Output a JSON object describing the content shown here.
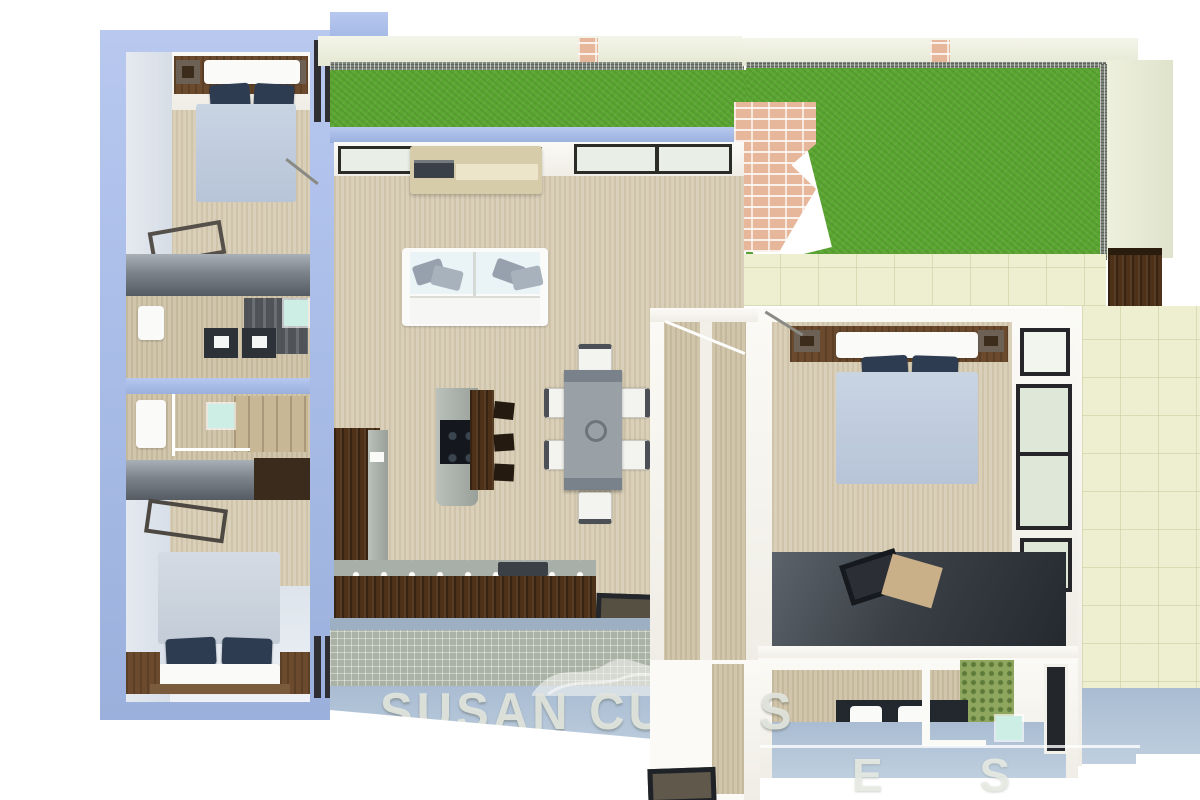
{
  "watermark": {
    "brand": "SUSAN CURTIS",
    "partial_letters": "E S",
    "logo": "mountain-swoosh-icon"
  },
  "scene": {
    "type": "3d-rendered-floor-plan-top-view",
    "rooms": [
      {
        "name": "bedroom-top-left",
        "furniture": [
          "double-bed",
          "navy-pillows",
          "headboard-shelf",
          "luggage-bench"
        ]
      },
      {
        "name": "bathroom-left-upper",
        "furniture": [
          "toilet",
          "washer",
          "dryer",
          "glass-shelf"
        ]
      },
      {
        "name": "bathroom-left-lower",
        "furniture": [
          "vanity-sink",
          "mirror",
          "closet"
        ]
      },
      {
        "name": "bedroom-bottom-left",
        "furniture": [
          "double-bed",
          "navy-pillows",
          "nightstands",
          "luggage-bench"
        ]
      },
      {
        "name": "living-room",
        "furniture": [
          "white-sofa",
          "tv-console",
          "air-conditioner",
          "windows"
        ]
      },
      {
        "name": "kitchen",
        "furniture": [
          "l-shaped-counter",
          "island-cooktop",
          "breakfast-bar",
          "bar-stools",
          "sink",
          "doormat"
        ]
      },
      {
        "name": "dining-area",
        "furniture": [
          "dining-table",
          "six-chairs",
          "center-bowl"
        ]
      },
      {
        "name": "walk-in-closet",
        "furniture": [
          "hanging-rail"
        ]
      },
      {
        "name": "master-bedroom",
        "furniture": [
          "double-bed",
          "navy-pillows",
          "wardrobe-platform",
          "laptop",
          "windows"
        ]
      },
      {
        "name": "master-bathroom",
        "furniture": [
          "double-sink-vanity",
          "shower-partition",
          "mosaic-accent-wall",
          "mirror"
        ]
      },
      {
        "name": "garden-lawn",
        "furniture": [
          "grass",
          "brick-barbecue",
          "gravel-border"
        ]
      },
      {
        "name": "side-patio",
        "furniture": [
          "pale-tile-floor",
          "planter-box"
        ]
      }
    ]
  },
  "colors": {
    "periwinkle": "#a9bde8",
    "grass": "#5ca733",
    "beige": "#d8ceb5",
    "wood": "#4e3119",
    "brick": "#e7b79c",
    "tile": "#edefd0",
    "navyPillow": "#2e3c52",
    "blanketBlue": "#b7c4d8",
    "mint": "#cdeee4",
    "blueFloor": "#bfcfdf",
    "wmcolor": "rgba(226,229,221,0.92)"
  }
}
